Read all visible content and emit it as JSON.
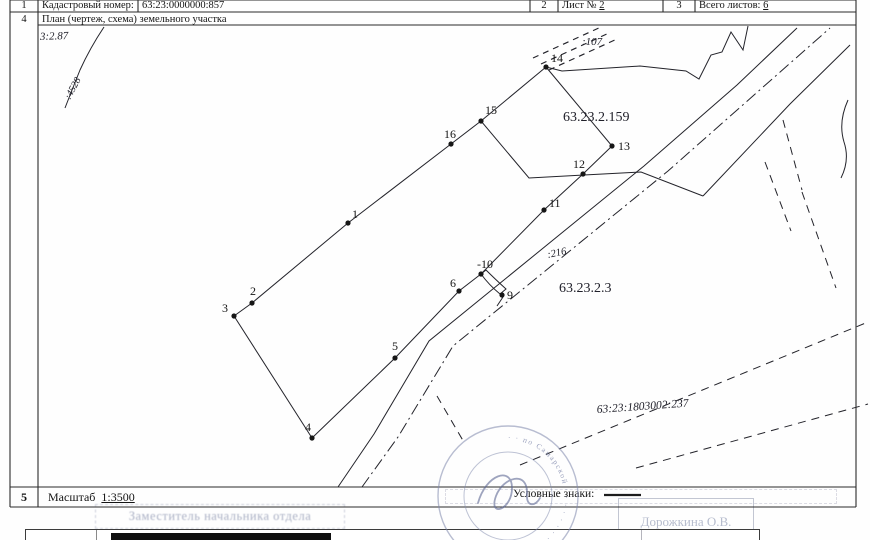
{
  "header": {
    "row1": {
      "num_kn": "1",
      "kn_label": "Кадастровый номер:",
      "kn_value": "63:23:0000000:857",
      "num_sheet": "2",
      "sheet_label": "Лист № ",
      "sheet_value": "2",
      "num_total": "3",
      "total_label": "Всего листов: ",
      "total_value": "6"
    },
    "row4": {
      "num": "4",
      "title": "План (чертеж, схема) земельного участка"
    }
  },
  "footer": {
    "num": "5",
    "scale_label": "Масштаб ",
    "scale_value": "1:3500",
    "legend_label": "Условные знаки:",
    "swatch": [
      604,
      495,
      641,
      495
    ]
  },
  "ghost": {
    "position_title": "Заместитель начальника отдела",
    "signer_name": "Дорожкина О.В."
  },
  "stamp": {
    "cx": 508,
    "cy": 496,
    "r_outer": 70,
    "r_inner": 44,
    "r_text": 56,
    "color": "#7e87ab",
    "ring_text": "· ·  по Самарской  · · · · · · · · · · · · · · · · · ·",
    "sig": "M478,503 C486,474 512,466 512,488 C512,510 488,518 496,496 C503,477 528,470 527,494 C526,508 536,506 540,498"
  },
  "plan": {
    "stroke": "#23232a",
    "grid": [
      [
        10,
        0,
        856,
        0
      ],
      [
        10,
        507,
        856,
        507
      ],
      [
        10,
        0,
        10,
        507
      ],
      [
        856,
        0,
        856,
        507
      ],
      [
        38,
        0,
        38,
        507
      ],
      [
        10,
        12,
        856,
        12
      ],
      [
        38,
        25,
        856,
        25
      ],
      [
        10,
        487,
        856,
        487
      ],
      [
        138,
        0,
        138,
        12
      ],
      [
        530,
        0,
        530,
        12
      ],
      [
        558,
        0,
        558,
        12
      ],
      [
        663,
        0,
        663,
        12
      ],
      [
        695,
        0,
        695,
        12
      ]
    ],
    "solid": [
      [
        [
          234,
          316
        ],
        [
          252,
          303
        ],
        [
          348,
          223
        ],
        [
          451,
          144
        ],
        [
          481,
          121
        ]
      ],
      [
        [
          481,
          121
        ],
        [
          546,
          67
        ]
      ],
      [
        [
          546,
          67
        ],
        [
          612,
          146
        ]
      ],
      [
        [
          612,
          146
        ],
        [
          583,
          174
        ],
        [
          544,
          210
        ],
        [
          481,
          274
        ]
      ],
      [
        [
          481,
          121
        ],
        [
          529,
          178
        ],
        [
          584,
          175
        ],
        [
          641,
          172
        ],
        [
          703,
          196
        ]
      ],
      [
        [
          234,
          316
        ],
        [
          312,
          438
        ]
      ],
      [
        [
          312,
          438
        ],
        [
          395,
          358
        ],
        [
          459,
          291
        ],
        [
          481,
          274
        ]
      ],
      [
        [
          546,
          67
        ],
        [
          562,
          71
        ],
        [
          640,
          66
        ],
        [
          686,
          71
        ],
        [
          699,
          79
        ],
        [
          711,
          55
        ],
        [
          722,
          52
        ],
        [
          731,
          32
        ],
        [
          743,
          50
        ],
        [
          748,
          26
        ]
      ],
      [
        [
          338,
          487
        ],
        [
          374,
          434
        ],
        [
          429,
          341
        ],
        [
          644,
          166
        ],
        [
          737,
          85
        ],
        [
          797,
          28
        ]
      ],
      [
        [
          703,
          196
        ],
        [
          790,
          104
        ],
        [
          850,
          45
        ]
      ]
    ],
    "dashdot": [
      [
        [
          362,
          487
        ],
        [
          398,
          437
        ],
        [
          453,
          346
        ],
        [
          668,
          171
        ],
        [
          830,
          28
        ]
      ]
    ],
    "dashed": [
      [
        [
          783,
          120
        ],
        [
          802,
          190
        ]
      ],
      [
        [
          765,
          162
        ],
        [
          791,
          231
        ]
      ],
      [
        [
          802,
          192
        ],
        [
          836,
          288
        ]
      ],
      [
        [
          520,
          465
        ],
        [
          868,
          322
        ]
      ],
      [
        [
          636,
          468
        ],
        [
          868,
          404
        ]
      ],
      [
        [
          437,
          396
        ],
        [
          465,
          444
        ]
      ]
    ],
    "hatch": [
      [
        [
          533,
          58
        ],
        [
          601,
          27
        ]
      ],
      [
        [
          541,
          64
        ],
        [
          609,
          33
        ]
      ],
      [
        [
          549,
          70
        ],
        [
          617,
          39
        ]
      ]
    ],
    "paths": [
      {
        "d": "M104,27 Q90,48 80,70 Q72,90 65,108"
      },
      {
        "d": "M848,100 Q838,122 844,142 Q850,160 841,178"
      },
      {
        "d": "M481,274 Q489,285 500,294 L506,289 Q495,279 486,270 Z"
      },
      {
        "d": "M503,297 L497,306"
      }
    ],
    "points": [
      {
        "n": "1",
        "x": 348,
        "y": 223,
        "lx": 352,
        "ly": 218
      },
      {
        "n": "2",
        "x": 252,
        "y": 303,
        "lx": 250,
        "ly": 295
      },
      {
        "n": "3",
        "x": 234,
        "y": 316,
        "lx": 222,
        "ly": 312
      },
      {
        "n": "4",
        "x": 312,
        "y": 438,
        "lx": 305,
        "ly": 431
      },
      {
        "n": "5",
        "x": 395,
        "y": 358,
        "lx": 392,
        "ly": 350
      },
      {
        "n": "6",
        "x": 459,
        "y": 291,
        "lx": 450,
        "ly": 287
      },
      {
        "n": "9",
        "x": 502,
        "y": 295,
        "lx": 507,
        "ly": 299
      },
      {
        "n": "-10",
        "x": 481,
        "y": 274,
        "lx": 477,
        "ly": 268
      },
      {
        "n": "11",
        "x": 544,
        "y": 210,
        "lx": 549,
        "ly": 207
      },
      {
        "n": "12",
        "x": 583,
        "y": 174,
        "lx": 573,
        "ly": 168
      },
      {
        "n": "13",
        "x": 612,
        "y": 146,
        "lx": 618,
        "ly": 150
      },
      {
        "n": "14",
        "x": 546,
        "y": 67,
        "lx": 551,
        "ly": 62
      },
      {
        "n": "15",
        "x": 481,
        "y": 121,
        "lx": 485,
        "ly": 114
      },
      {
        "n": "16",
        "x": 451,
        "y": 144,
        "lx": 444,
        "ly": 138
      }
    ],
    "labels": [
      {
        "t": "3:2.87",
        "x": 40,
        "y": 40,
        "s": 11,
        "i": 1,
        "r": -2
      },
      {
        "t": ":4528",
        "x": 70,
        "y": 100,
        "s": 10,
        "i": 1,
        "r": -62
      },
      {
        "t": ":107",
        "x": 582,
        "y": 45,
        "s": 11,
        "i": 1,
        "r": 0
      },
      {
        "t": "63.23.2.159",
        "x": 563,
        "y": 121,
        "s": 14,
        "i": 0,
        "r": 0
      },
      {
        "t": ":216",
        "x": 548,
        "y": 258,
        "s": 10.5,
        "i": 1,
        "r": -12
      },
      {
        "t": "63.23.2.3",
        "x": 559,
        "y": 292,
        "s": 14,
        "i": 0,
        "r": 0
      },
      {
        "t": "63:23:1803002:237",
        "x": 597,
        "y": 413,
        "s": 11.5,
        "i": 1,
        "r": -4
      }
    ]
  }
}
